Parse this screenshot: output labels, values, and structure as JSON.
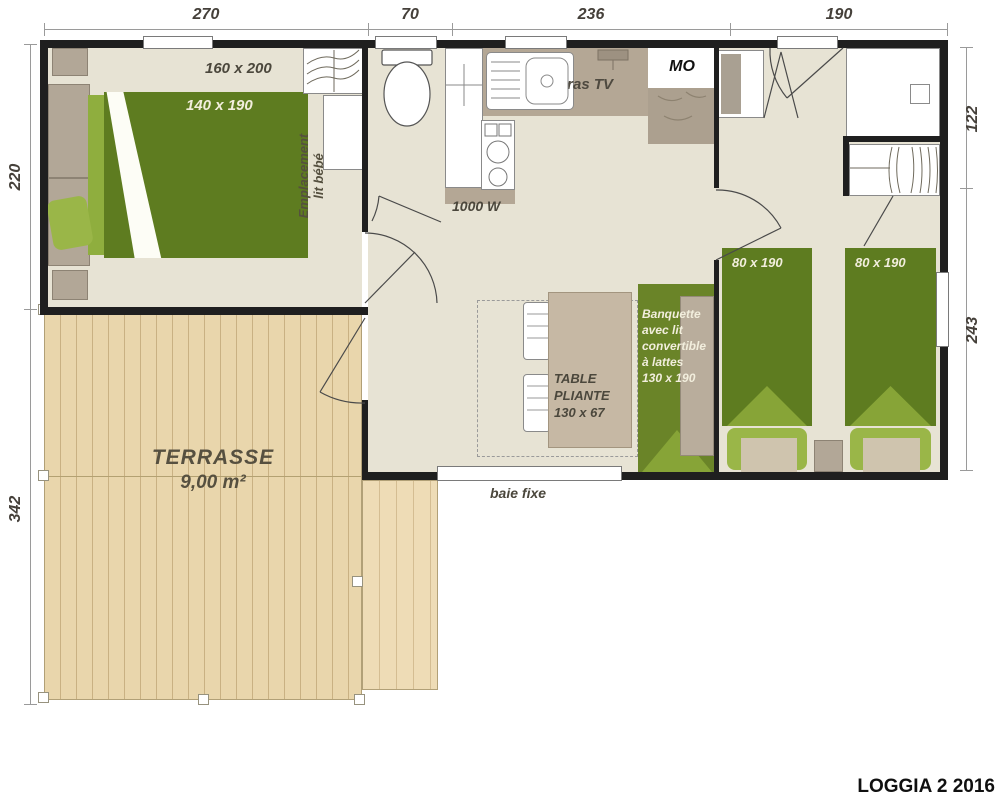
{
  "title": "LOGGIA 2 2016",
  "dims": {
    "top": [
      "270",
      "70",
      "236",
      "190"
    ],
    "left": [
      "220",
      "342"
    ],
    "right": [
      "122",
      "243"
    ]
  },
  "master": {
    "room_size": "160 x 200",
    "bed_size": "140 x 190",
    "crib1": "Emplacement",
    "crib2": "lit bébé"
  },
  "kitchen": {
    "tv": "bras TV",
    "mo": "MO",
    "power": "1000 W"
  },
  "twin": {
    "bed1": "80 x 190",
    "bed2": "80 x 190"
  },
  "living": {
    "banquette": [
      "Banquette",
      "avec lit",
      "convertible",
      "à lattes",
      "130 x 190"
    ],
    "table": [
      "TABLE",
      "PLIANTE",
      "130 x 67"
    ]
  },
  "terrace": {
    "name": "TERRASSE",
    "area": "9,00 m²",
    "bay": "baie fixe"
  },
  "colors": {
    "wall": "#1f1f1f",
    "floor": "#e7e3d4",
    "bed_green": "#5e7c20",
    "light_green": "#8fae3e",
    "wood": "#e9d6ac",
    "counter": "#b4a795",
    "table": "#c6b8a4"
  }
}
